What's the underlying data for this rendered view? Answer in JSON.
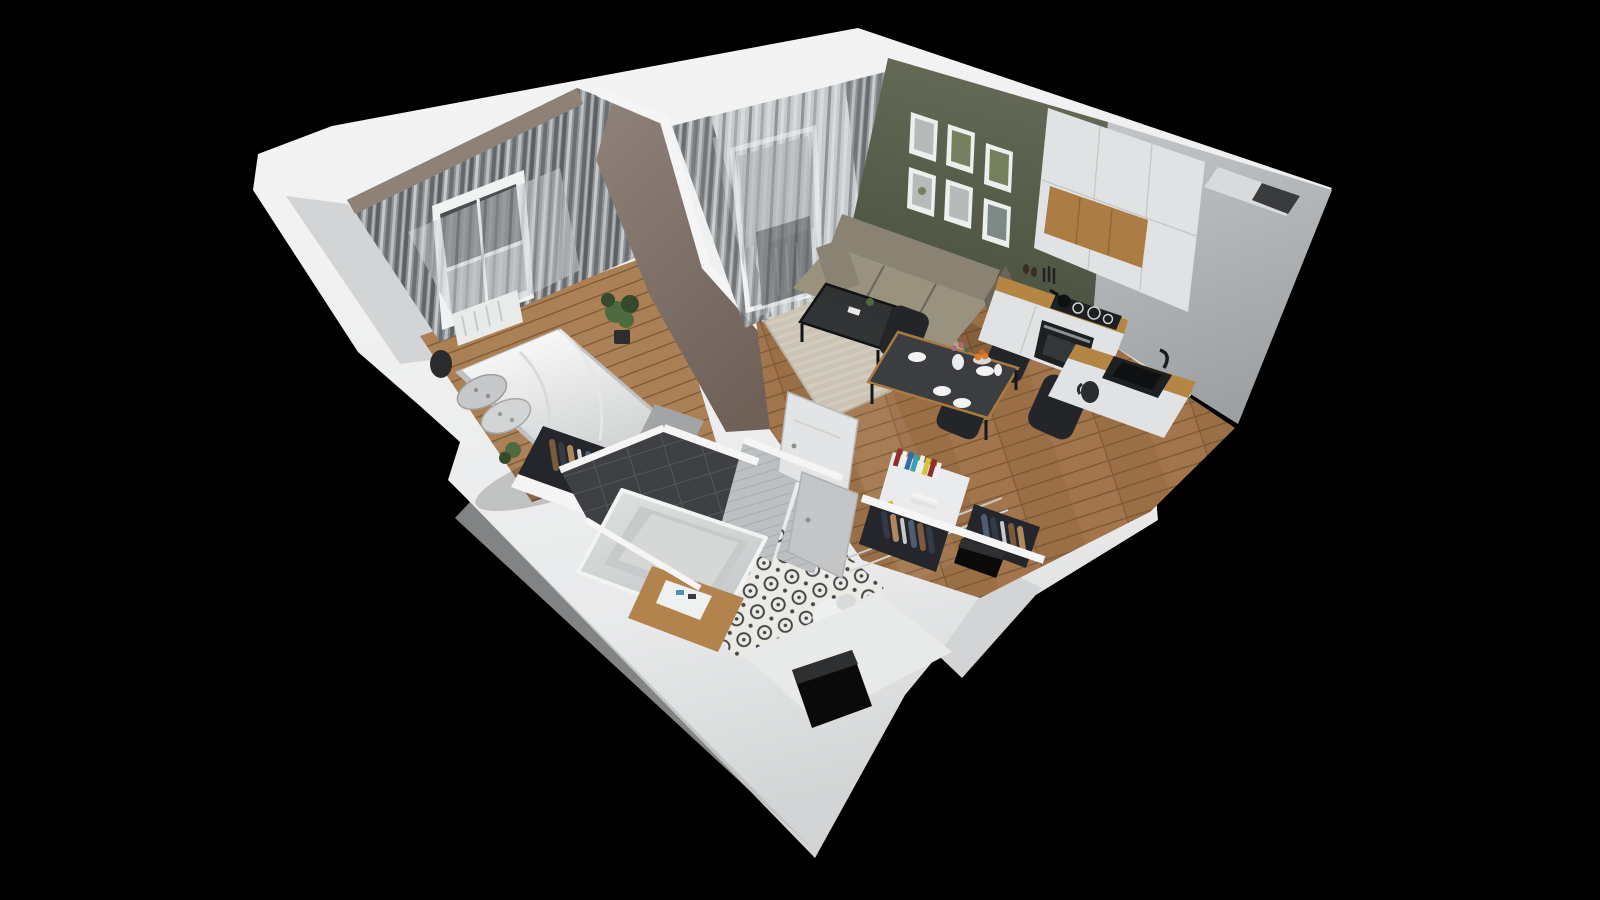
{
  "scene": {
    "title": "3D isometric cutaway floor plan render of a one-bedroom apartment",
    "view": "isometric-cutaway",
    "width": 1600,
    "height": 900,
    "background": "#000000"
  },
  "palette": {
    "bg": "#000000",
    "wall_top": "#f5f5f5",
    "wall_face": "#e9eaeb",
    "wall_shade": "#d2d4d5",
    "wall_dark": "#b8babc",
    "bedroom_wall": "#8e8177",
    "bedroom_wall_dark": "#6e635a",
    "partition_wall": "#8f827a",
    "partition_dark": "#6f6158",
    "curtain_dark": "#5c5f63",
    "curtain_mid": "#8f9396",
    "curtain_light": "#c7cacc",
    "sheer_light": "#d9dcdd",
    "window_frame": "#f1f2f2",
    "window_glass": "#a4a8ab",
    "glass_dark": "#4a4e51",
    "radiator_dark": "#3c3f41",
    "radiator_white": "#e9eaea",
    "olive_wall": "#636955",
    "olive_dark": "#474d3c",
    "frame_white": "#edefed",
    "art_gray": "#b6bab9",
    "art_green": "#75805e",
    "art_dark": "#7e8a88",
    "sofa": "#8a8374",
    "sofa_dark": "#6b6457",
    "sofa_light": "#99927f",
    "rug": "#cbc4b5",
    "rug_light": "#dad4c6",
    "wood_floor": "#9b6f46",
    "wood_light": "#b3855a",
    "wood_dark": "#7c5835",
    "bedroom_floor": "#aa8054",
    "table_top": "#3b3d40",
    "table_wood_edge": "#a97a3f",
    "chair_black": "#232528",
    "plate_white": "#f2f3f3",
    "orange_fruit": "#e07a2a",
    "flower_pink": "#b06a76",
    "kitchen_wall": "#c3c6c8",
    "kitchen_wall_dark": "#9ea1a3",
    "cabinet_white": "#e0e2e3",
    "cabinet_shade": "#c2c5c6",
    "cabinet_wood": "#ab7d44",
    "counter_wood": "#b58643",
    "appliance_dark": "#1d1f21",
    "steel": "#8d9093",
    "tile_dark": "#3e4043",
    "tile_dark_line": "#54565a",
    "tile_light": "#bcc0c2",
    "tile_light_line": "#a8acae",
    "tub_white": "#dfe1e1",
    "tub_inner": "#c7cacb",
    "tub_rim": "#f0f1f1",
    "bath_floor_bg": "#eceae4",
    "bath_floor_ink": "#45474b",
    "vanity_wood": "#b2834c",
    "sink_white": "#eff0f0",
    "door_white": "#e3e4e5",
    "door_shade": "#c3c5c7",
    "book_red": "#8e2f2a",
    "book_blue": "#2e6ea3",
    "book_teal": "#3aa0b4",
    "book_yellow": "#d8c23a",
    "book_white": "#efefed",
    "clothes_brown": "#7a5a3c",
    "clothes_tan": "#b0885f",
    "clothes_blue": "#4e5d72",
    "clothes_navy": "#333a46",
    "rack_dark": "#24262b",
    "plant_green": "#4e6b3f",
    "plant_dark": "#35492b",
    "hole_black": "#0a0a0b",
    "hole_edge": "#2e2f31",
    "entry_floor": "#e8e9e9"
  },
  "rooms": {
    "bedroom": {
      "name": "bedroom",
      "items": [
        "window",
        "curtains",
        "double-bed",
        "pillows",
        "clothes-rack",
        "dresser",
        "plant",
        "trash-bin",
        "radiator",
        "wood-floor"
      ]
    },
    "living_room": {
      "name": "living room",
      "items": [
        "balcony-window",
        "sheer-curtains",
        "radiator",
        "sofa",
        "coffee-table",
        "rug",
        "gallery-wall",
        "dining-table",
        "dining-chairs",
        "wood-floor"
      ],
      "gallery_frame_count": 6,
      "dining_chair_count": 4,
      "dining_table_items": [
        "plates",
        "vase-with-flowers",
        "fruit-bowl",
        "carafe"
      ]
    },
    "kitchen": {
      "name": "kitchen",
      "items": [
        "tall-cabinets",
        "upper-cabinets",
        "wood-panel",
        "countertop",
        "cooktop",
        "pan",
        "oven",
        "knife-block",
        "sink",
        "faucet",
        "kettle"
      ]
    },
    "bathroom": {
      "name": "bathroom",
      "items": [
        "bathtub",
        "dark-tile-wall",
        "light-tile-walls",
        "patterned-tile-floor",
        "vanity-sink",
        "toilet",
        "open-door"
      ]
    },
    "hallway": {
      "name": "hallway",
      "items": [
        "bookshelf",
        "books",
        "open-wardrobe-niches",
        "hanging-clothes",
        "entry-floor"
      ]
    },
    "shafts": {
      "name": "installation shafts",
      "count": 3
    }
  }
}
